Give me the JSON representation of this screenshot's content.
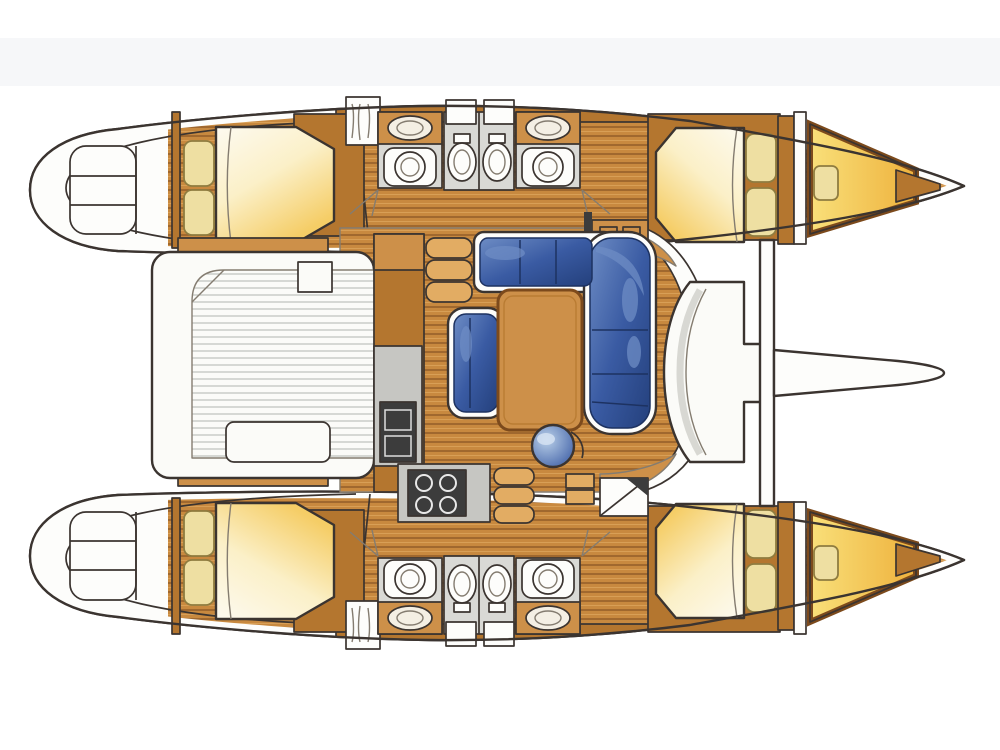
{
  "page": {
    "background": "#ffffff",
    "top_band": "#eff1f4"
  },
  "colors": {
    "outline": "#3b3430",
    "outline_soft": "#847c70",
    "hull_white": "#fdfdfb",
    "wood": "#cd9049",
    "wood_dark": "#b4762f",
    "wood_deep": "#7c4a1c",
    "wood_light": "#e2ac63",
    "plank_base": "#c8893f",
    "plank_line": "#96602a",
    "floor_grey": "#d9d9d5",
    "counter_grey": "#c6c6c2",
    "appliance_dark": "#3c3c3c",
    "bed_white": "#fdfaf0",
    "bed_yellow": "#f5cd66",
    "pillow": "#eedfa2",
    "pillow_edge": "#8f7c40",
    "sofa_dark": "#24407c",
    "sofa_mid": "#3a5ba3",
    "sofa_light": "#6d8cc4",
    "sofa_edge": "#1d3261",
    "bench_white": "#fbfbf8",
    "teak_line": "#b9bcb6"
  },
  "scene": {
    "type": "catamaran-floor-plan",
    "view": "top-down",
    "orientation": "bow-right",
    "hull_regions": [
      "stern-swim-steps",
      "aft-double-berth-cabin",
      "hanging-wardrobe",
      "aft-head-sink-toilet",
      "twin-toilet-compartments",
      "forward-head-sink-toilet",
      "forward-double-berth-cabin",
      "forepeak-v-berth"
    ],
    "bridgedeck_regions": [
      "aft-cockpit-teak-deck",
      "cockpit-bench",
      "galley-fridge-stove-counter",
      "saloon-table",
      "l-shaped-settee",
      "armchair",
      "round-stool",
      "shelf-unit",
      "chart-corner",
      "forward-cockpit-bench",
      "forward-crossbeam",
      "bowsprit",
      "trampoline"
    ],
    "starboard_hull": "mirror-of-port-hull"
  }
}
